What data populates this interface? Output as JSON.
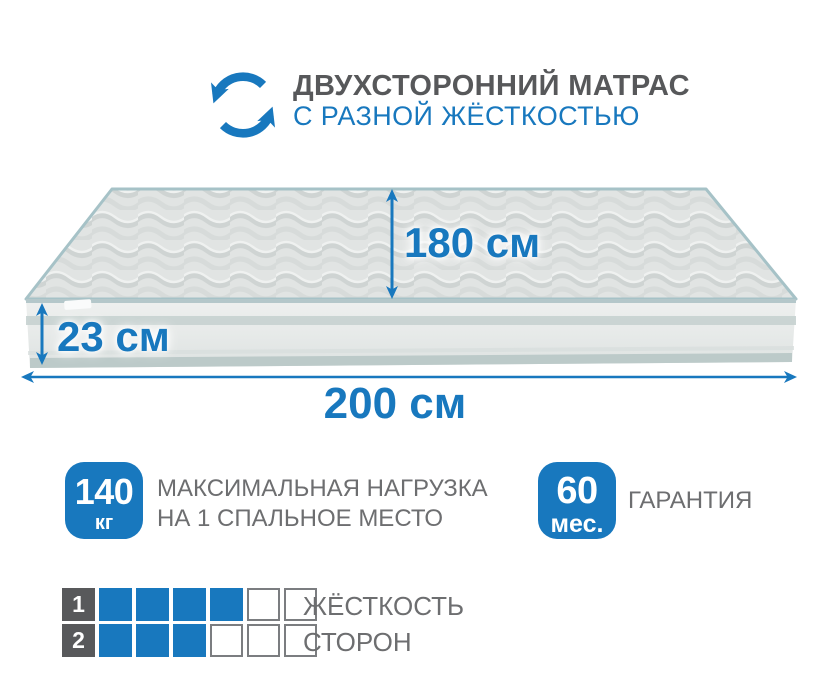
{
  "header": {
    "icon": "rotate-arrows-icon",
    "title": "ДВУХСТОРОННИЙ МАТРАС",
    "subtitle": "С РАЗНОЙ ЖЁСТКОСТЬЮ"
  },
  "dimensions": {
    "depth": "180 см",
    "height": "23 см",
    "length": "200 см"
  },
  "badges": {
    "max_load": {
      "value": "140",
      "unit": "кг",
      "line1": "МАКСИМАЛЬНАЯ НАГРУЗКА",
      "line2": "НА 1 СПАЛЬНОЕ МЕСТО"
    },
    "warranty": {
      "value": "60",
      "unit": "мес.",
      "label": "ГАРАНТИЯ"
    }
  },
  "firmness": {
    "label_line1": "ЖЁСТКОСТЬ",
    "label_line2": "СТОРОН",
    "scale_total": 6,
    "rows": [
      {
        "side": "1",
        "filled": 4
      },
      {
        "side": "2",
        "filled": 3
      }
    ]
  },
  "colors": {
    "accent_blue": "#1878be",
    "dark_gray_text": "#57585a",
    "gray_text": "#6d6e70",
    "square_dark": "#58595b"
  }
}
